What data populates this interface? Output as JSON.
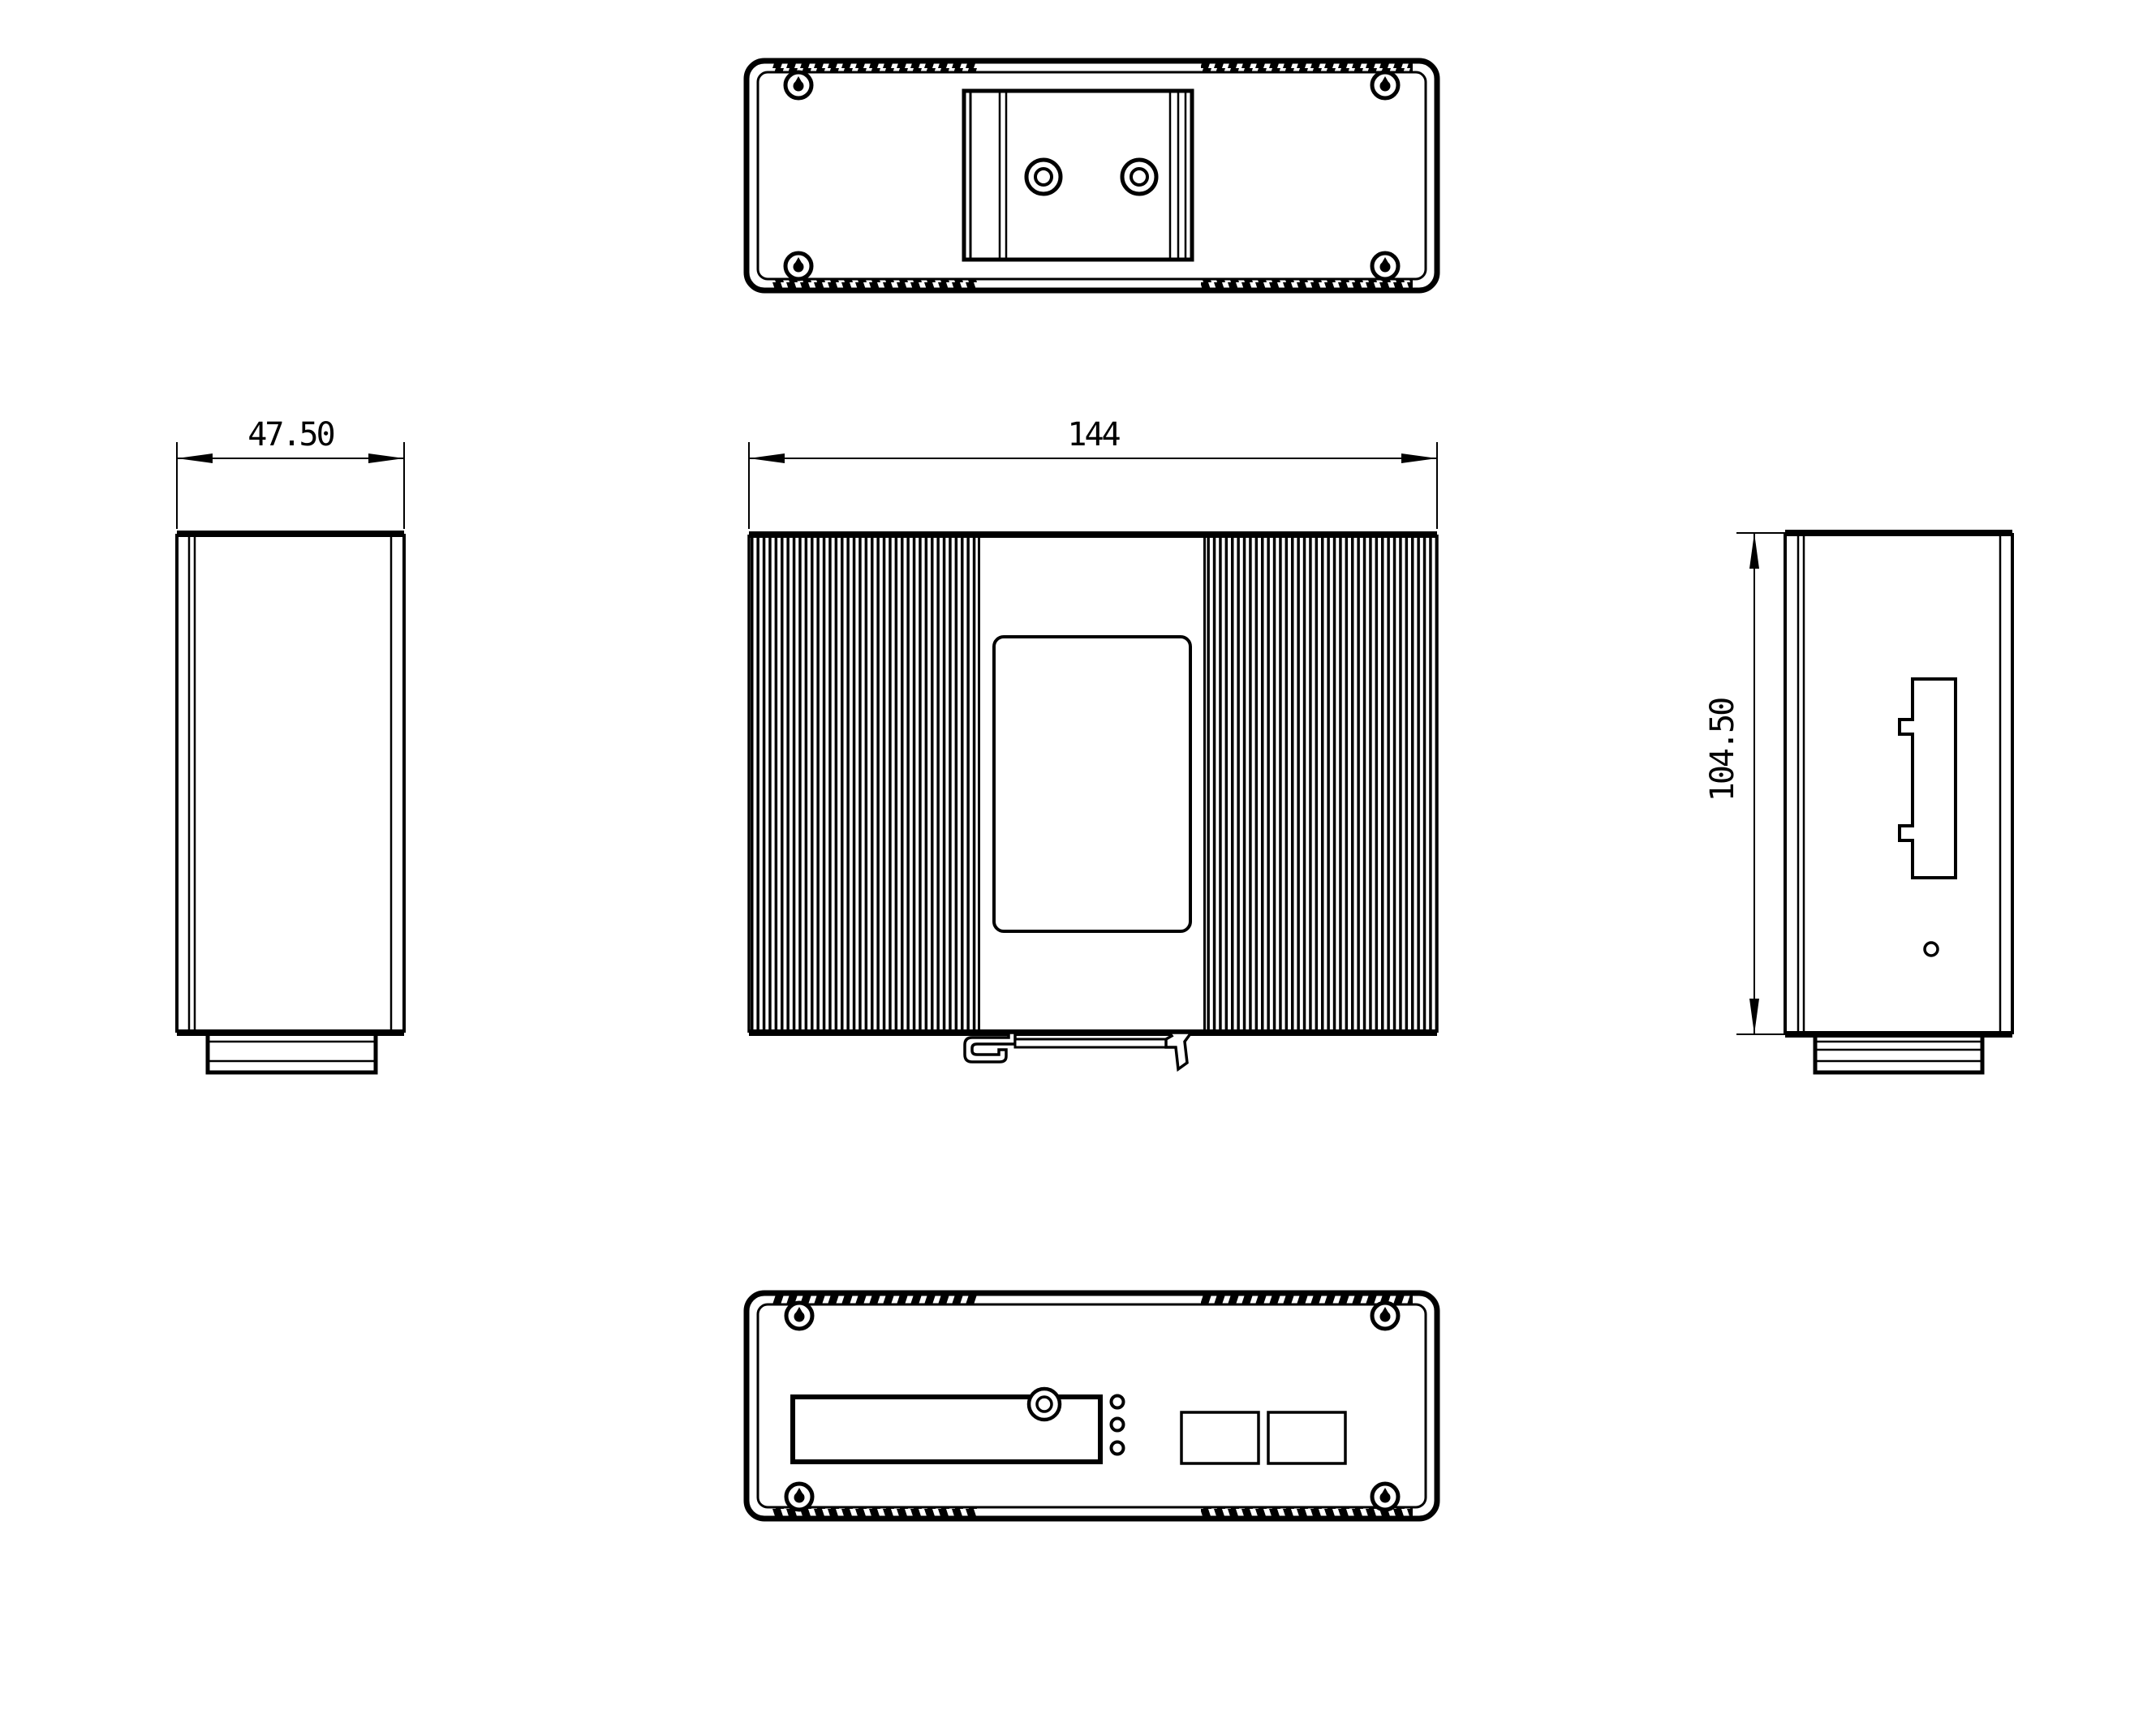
{
  "drawing": {
    "background": "#ffffff",
    "line_color": "#000000",
    "dimensions": {
      "width": "144",
      "depth": "47.50",
      "height": "104.50"
    }
  }
}
